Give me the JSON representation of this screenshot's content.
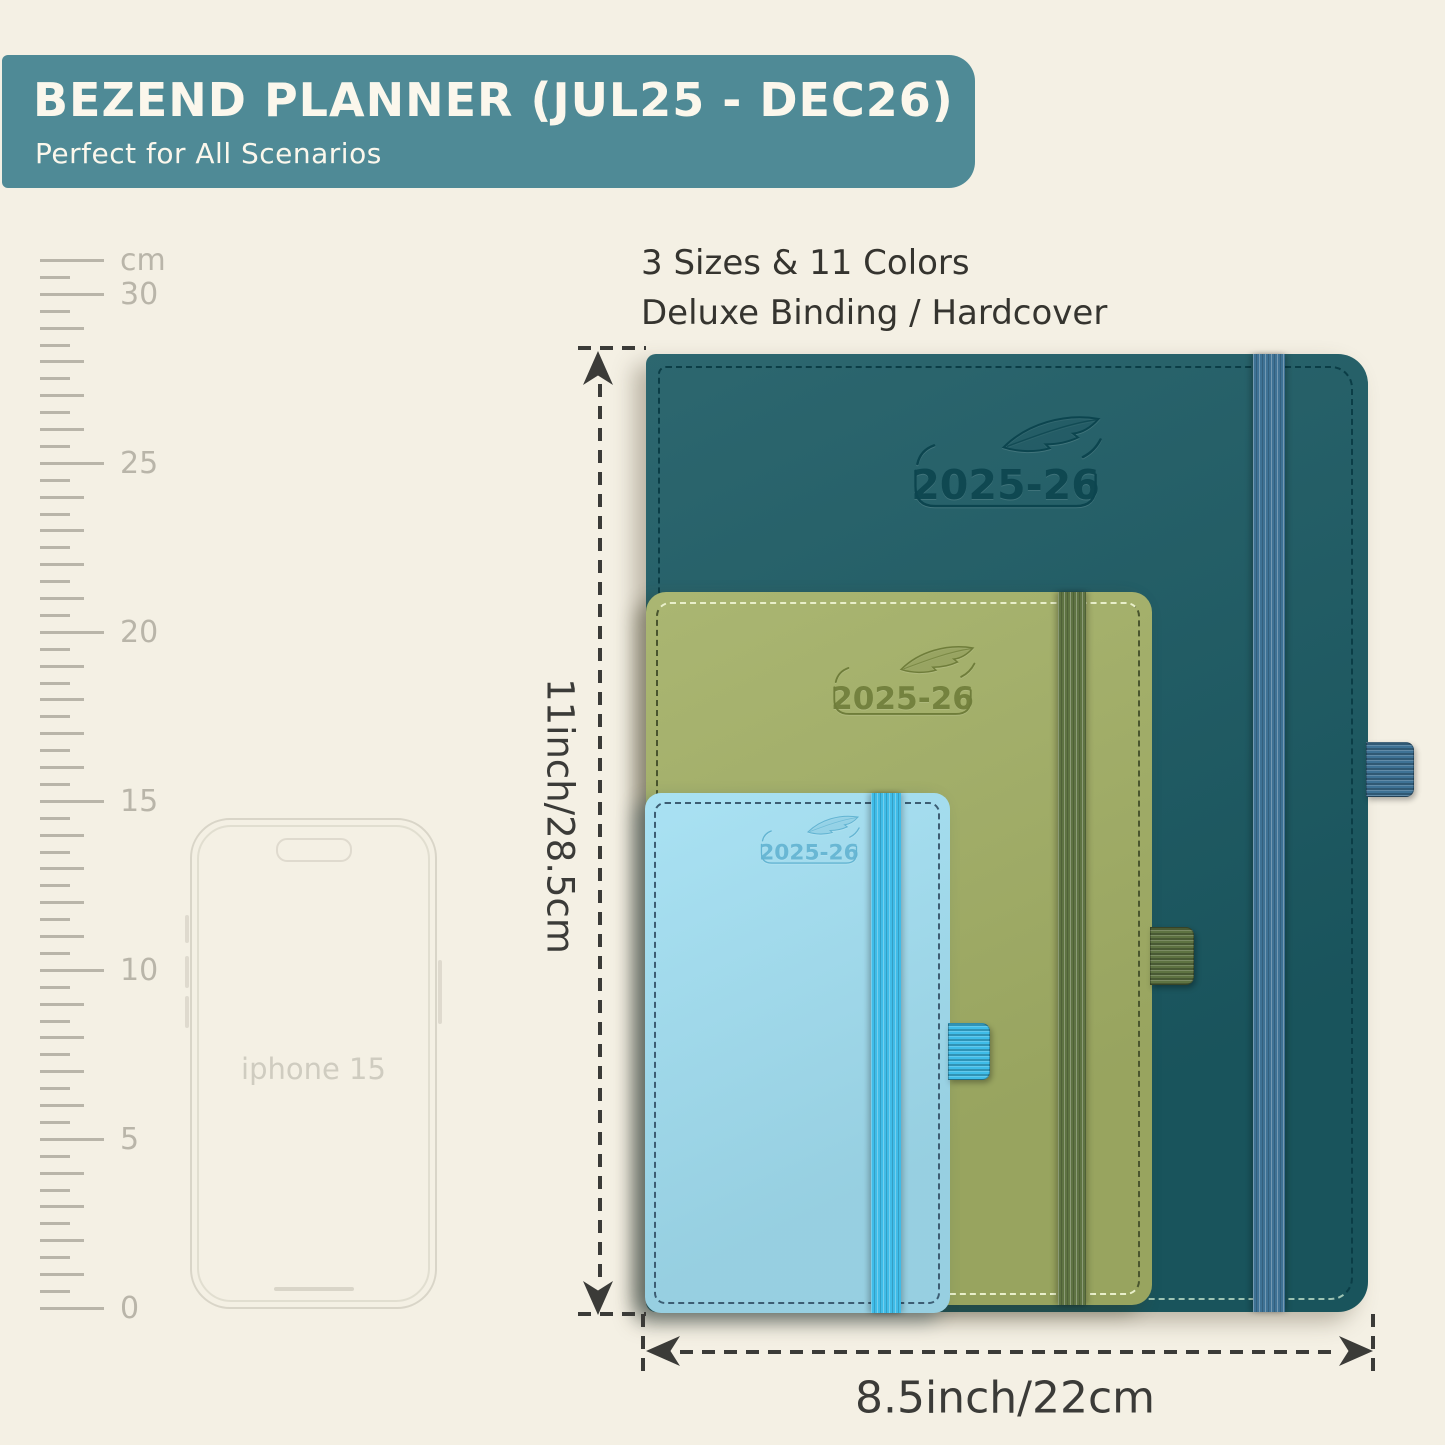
{
  "banner": {
    "title": "BEZEND PLANNER (JUL25 - DEC26)",
    "subtitle": "Perfect for All Scenarios",
    "bg": "#4f8a96",
    "text_color": "#fbf7ec"
  },
  "info": {
    "line1": "3 Sizes & 11 Colors",
    "line2": "Deluxe Binding / Hardcover"
  },
  "ruler": {
    "unit": "cm",
    "marks": [
      "30",
      "25",
      "20",
      "15",
      "10",
      "5",
      "0"
    ],
    "color": "#b9b5a9"
  },
  "phone": {
    "label": "iphone 15",
    "outline_color": "#d9d5c8"
  },
  "planners": [
    {
      "size": "large",
      "year": "2025-26",
      "cover": "#1b5a63",
      "band": "#3e7295",
      "emboss": "#0c454f",
      "stitch_light": "#9ec4b4",
      "stitch_dark": "#0b3d46"
    },
    {
      "size": "medium",
      "year": "2025-26",
      "cover": "#a3b066",
      "band": "#5e7342",
      "emboss": "#6f7d3a",
      "stitch_light": "#e9efca",
      "stitch_dark": "#49552e"
    },
    {
      "size": "small",
      "year": "2025-26",
      "cover": "#a2dff2",
      "band": "#3fbce8",
      "emboss": "#63b4d2",
      "stitch_light": "#cfeaf5",
      "stitch_dark": "#3c5d73"
    }
  ],
  "dimensions": {
    "height_label": "11inch/28.5cm",
    "width_label": "8.5inch/22cm",
    "line_color": "#3b3b38"
  }
}
